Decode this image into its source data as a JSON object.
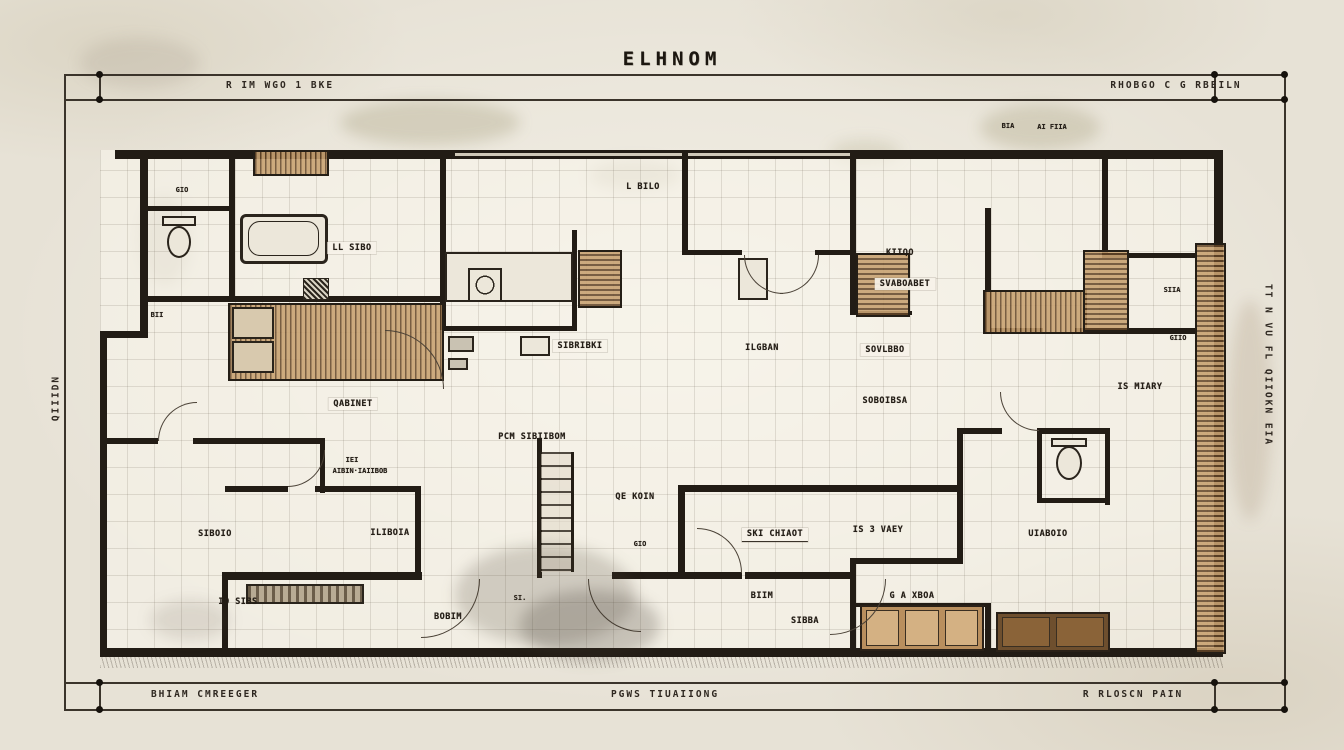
{
  "title": "ELHNOM",
  "dimensions": {
    "top_left": "R IM WGO 1 BKE",
    "top_right": "RHOBGO C G RBEILN",
    "bottom_left": "BHIAM CMREEGER",
    "bottom_center": "PGWS TIUAIIONG",
    "bottom_right": "R RLOSCN PAIN",
    "left": "QIIIDN",
    "right": "TT N VU FL  QIIOKN EIA"
  },
  "palette": {
    "paper": "#e7e2d6",
    "ink": "#241e17",
    "wood": "#b98f5e"
  },
  "rooms": [
    {
      "label": "LL SIBO"
    },
    {
      "label": "L BILO"
    },
    {
      "label": "KIIQO"
    },
    {
      "label": "SVABOABET"
    },
    {
      "label": "SIBRIBKI"
    },
    {
      "label": "ILGBAN"
    },
    {
      "label": "SOVLBBO"
    },
    {
      "label": "SOBOIBSA"
    },
    {
      "label": "QABINET"
    },
    {
      "label": "PCM SIBIIBOM"
    },
    {
      "label": "QE KOIN"
    },
    {
      "label": "SKI CHIAOT"
    },
    {
      "label": "IS 3 VAEY"
    },
    {
      "label": "SIBOIO"
    },
    {
      "label": "ILIBOIA"
    },
    {
      "label": "IO SIBS"
    },
    {
      "label": "BOBIM"
    },
    {
      "label": "BIIM"
    },
    {
      "label": "SIBBA"
    },
    {
      "label": "G A XBOA"
    },
    {
      "label": "UIABOIO"
    },
    {
      "label": "IS MIARY"
    },
    {
      "label": "SIIA"
    },
    {
      "label": "GIIO"
    },
    {
      "label": "BIA"
    },
    {
      "label": "AI FIIA"
    },
    {
      "label": "SI."
    },
    {
      "label": "GIO"
    },
    {
      "label": "BII"
    },
    {
      "label": "GIO"
    },
    {
      "label": "IEI"
    },
    {
      "label": "AIBIN·IAIIBOB"
    }
  ]
}
